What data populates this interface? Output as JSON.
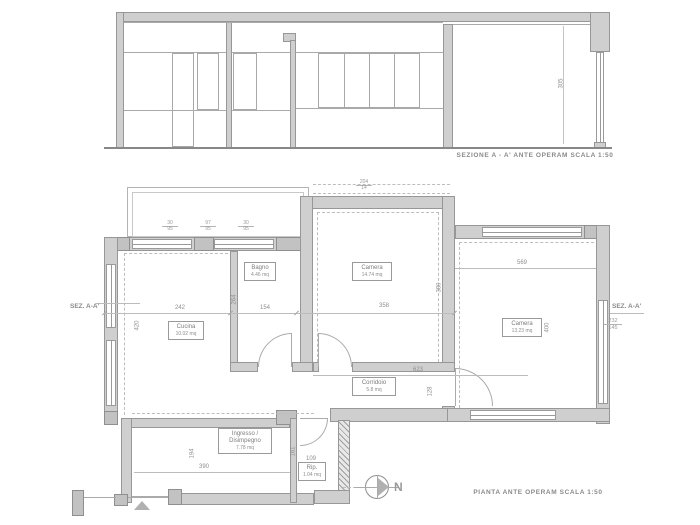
{
  "titles": {
    "section": "SEZIONE A - A' ANTE OPERAM SCALA 1:50",
    "plan": "PIANTA ANTE OPERAM SCALA 1:50",
    "sez_left": "SEZ. A-A'",
    "sez_right": "SEZ. A-A'",
    "north": "N"
  },
  "rooms": [
    {
      "name": "Cucina",
      "area": "10.02 mq"
    },
    {
      "name": "Bagno",
      "area": "4.46 mq"
    },
    {
      "name": "Camera",
      "area": "14.74 mq"
    },
    {
      "name": "Camera",
      "area": "13.23 mq"
    },
    {
      "name": "Corridoio",
      "area": "5.8 mq"
    },
    {
      "name": "Ingresso /",
      "name2": "Disimpegno",
      "area": "7.78 mq"
    },
    {
      "name": "Rip.",
      "area": "1.04 mq"
    }
  ],
  "dims": {
    "cucina_w": "242",
    "bagno_depth": "264",
    "bagno_w": "154",
    "camera_mid_w": "358",
    "camera_right_w": "569",
    "cucina_h": "420",
    "camera_mid_h": "380",
    "camera_right_h": "400",
    "corridoio_w": "623",
    "corridoio_h": "128",
    "ingresso_h": "194",
    "ingresso_w": "390",
    "rip_h": "161",
    "rip_w": "109",
    "section_h": "305",
    "level_top": "232",
    "level_bottom": "145",
    "t1_top": "30",
    "t1_bot": "95",
    "t2_top": "97",
    "t2_bot": "95",
    "t3_top": "30",
    "t3_bot": "95",
    "t4_top": "204",
    "t4_bot": "14"
  },
  "colors": {
    "wall": "#cfcfcf",
    "accent_line": "#9a9a9a",
    "text": "#8f8f8f"
  }
}
